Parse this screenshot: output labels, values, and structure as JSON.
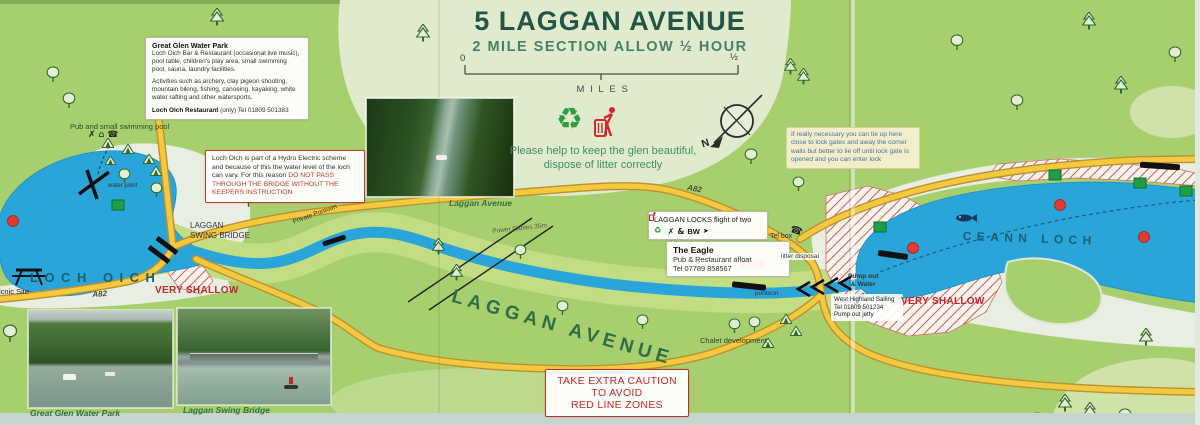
{
  "title": {
    "heading": "5 LAGGAN AVENUE",
    "subheading": "2 MILE SECTION ALLOW ½ HOUR"
  },
  "scale_bar": {
    "start": "0",
    "end": "½",
    "unit": "MILES"
  },
  "compass": {
    "north": "N"
  },
  "litter_notice": {
    "line1": "Please help to keep the glen beautiful,",
    "line2": "dispose of litter correctly"
  },
  "boxes": {
    "water_park": {
      "heading": "Great Glen Water Park",
      "body1": "Loch Oich Bar & Restaurant (occasional live music), pool table, children's play area, small swimming pool, sauna, laundry facilities.",
      "body2": "Activities such as archery, clay pigeon shooting, mountain biking, fishing, canoeing, kayaking, white water rafting and other watersports.",
      "footer_bold": "Loch Oich Restaurant",
      "footer_rest": " (only) Tel 01809 501383"
    },
    "hydro": {
      "body": "Loch Oich is part of a Hydro Electric scheme and because of this the water level of the loch can vary. For this reason ",
      "warning": "DO NOT PASS THROUGH THE BRIDGE WITHOUT THE KEEPERS INSTRUCTION"
    },
    "mooring": {
      "text": "If really necessary you can tie up here close to lock gates and away the corner walls but better to lie off until lock gate is opened and you can enter lock"
    },
    "laggan_locks": {
      "title": "LAGGAN LOCKS flight of two",
      "bw": "BW"
    },
    "eagle": {
      "name": "The Eagle",
      "line1": "Pub & Restaurant afloat",
      "line2": "Tel 07789 858567"
    },
    "sailing": {
      "line1": "West Highland Sailing",
      "line2": "Tel 01809 501234",
      "line3": "Pump out jetty"
    },
    "caution": {
      "line1": "TAKE EXTRA CAUTION",
      "line2": "TO AVOID",
      "line3": "RED LINE ZONES"
    }
  },
  "labels": {
    "loch_oich": "LOCH OICH",
    "ceann_loch": "CEANN LOCH",
    "laggan_swing_bridge_1": "LAGGAN",
    "laggan_swing_bridge_2": "SWING BRIDGE",
    "very_shallow": "VERY SHALLOW",
    "laggan_avenue": "LAGGAN AVENUE",
    "a82": "A82",
    "private_pontoon": "Private Pontoon",
    "power_cables": "Power Cables 35m",
    "tel_box": "Tel box",
    "litter_disposal": "litter disposal",
    "pontoon": "pontoon",
    "chalet_development": "Chalet development",
    "pump_out_1": "Pump out",
    "pump_out_2": "& Water",
    "picnic_site": "Picnic Site",
    "pub_pool": "Pub and small swimming pool",
    "water_point": "water point"
  },
  "photos": {
    "canal_caption": "Laggan Avenue",
    "water_park_caption": "Great Glen Water Park",
    "bridge_caption": "Laggan Swing Bridge"
  },
  "icons": {
    "recycle": "♻",
    "food": "✗",
    "facilities": "&",
    "arrow": "➤",
    "phone": "☎",
    "building": "⌂"
  },
  "colors": {
    "water": "#2ea7da",
    "road": "#f4c93f",
    "warning_red": "#c0282d",
    "map_green": "#a8cf6e",
    "accent_green": "#2f9e41"
  }
}
